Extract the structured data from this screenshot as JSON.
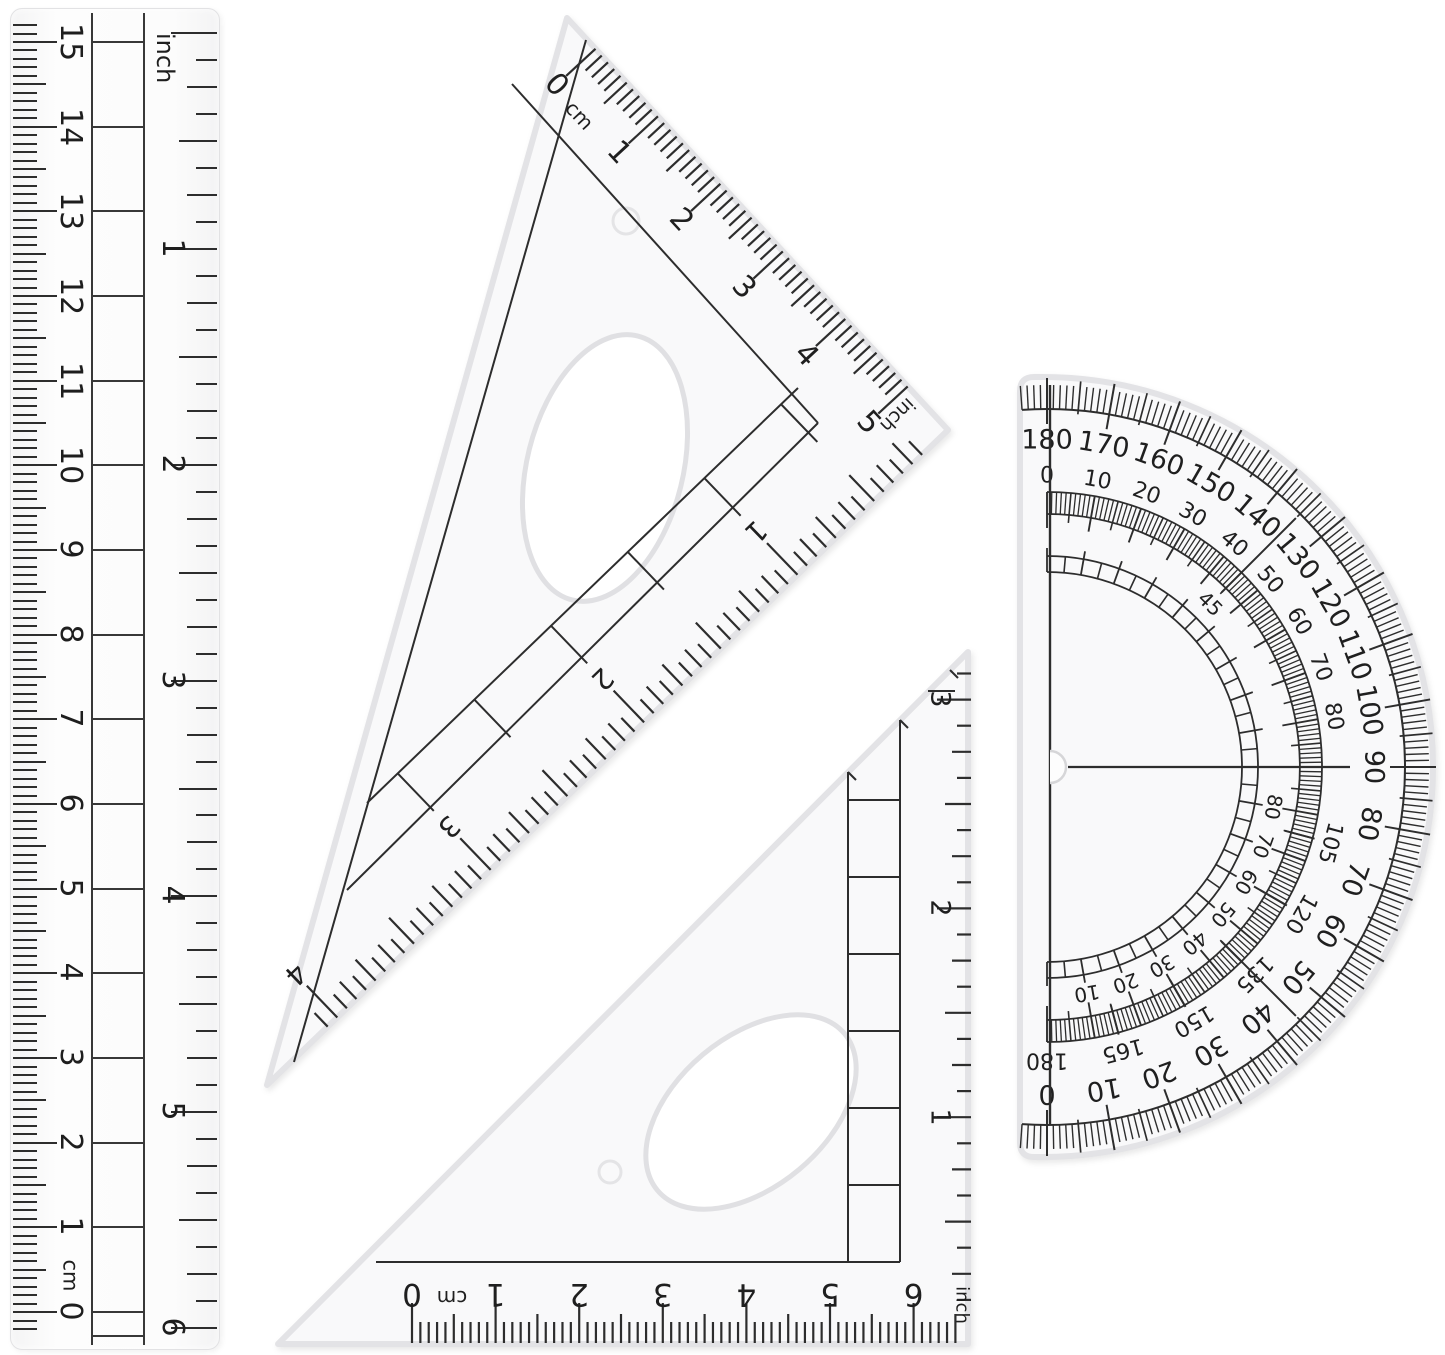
{
  "ruler": {
    "cm_numbers": [
      "15",
      "14",
      "13",
      "12",
      "11",
      "10",
      "9",
      "8",
      "7",
      "6",
      "5",
      "4",
      "3",
      "2",
      "1",
      "0"
    ],
    "cm_unit": "cm",
    "inch_unit": "inch",
    "inch_numbers": [
      "1",
      "2",
      "3",
      "4",
      "5",
      "6"
    ]
  },
  "triangle_large": {
    "cm_start": "0",
    "cm_unit": "cm",
    "cm_numbers": [
      "1",
      "2",
      "3",
      "4",
      "5"
    ],
    "inch_unit": "inch",
    "inch_numbers": [
      "1",
      "2",
      "3",
      "4"
    ]
  },
  "triangle_small": {
    "cm_start": "0",
    "cm_unit": "cm",
    "cm_numbers": [
      "1",
      "2",
      "3",
      "4",
      "5",
      "6"
    ],
    "inch_unit": "inch",
    "inch_numbers": [
      "1",
      "2",
      "3"
    ]
  },
  "protractor": {
    "outer_scale": [
      "180",
      "170",
      "160",
      "150",
      "140",
      "130",
      "120",
      "110",
      "100",
      "90",
      "80",
      "70",
      "60",
      "50",
      "40",
      "30",
      "20",
      "10",
      "0"
    ],
    "inner_scale_top": [
      "0",
      "10",
      "20",
      "30",
      "40",
      "50",
      "60",
      "70",
      "80"
    ],
    "inner_scale_bottom": [
      "105",
      "120",
      "135",
      "150",
      "165",
      "180"
    ],
    "mid_label": "45",
    "innermost_bottom": [
      "10",
      "20",
      "30",
      "40",
      "50",
      "60",
      "70",
      "80"
    ]
  }
}
